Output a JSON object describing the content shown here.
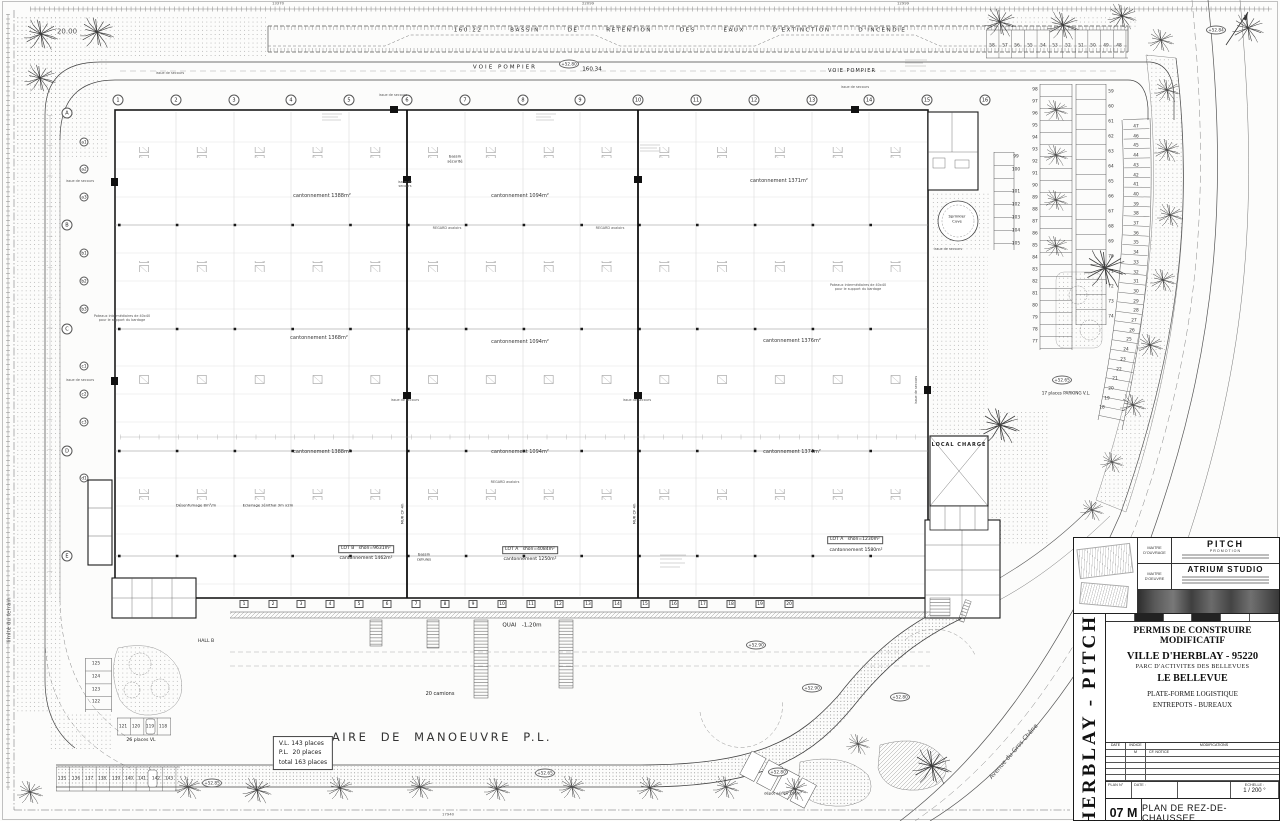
{
  "header": {
    "basin": "160.22   BASSIN   DE   RETENTION   DES   EAUX   D'EXTINCTION   D'INCENDIE",
    "voie_pompier_left": "VOIE POMPIER",
    "level": "160.34",
    "voie_pompier_right": "VOIE POMPIER"
  },
  "dims": [
    {
      "text": "13370",
      "x": 278,
      "y": 4
    },
    {
      "text": "22099",
      "x": 588,
      "y": 4
    },
    {
      "text": "12999",
      "x": 903,
      "y": 4
    },
    {
      "text": "17940",
      "x": 448,
      "y": 815
    }
  ],
  "grid": {
    "cols": [
      {
        "text": "1",
        "x": 118,
        "y": 100
      },
      {
        "text": "2",
        "x": 176,
        "y": 100
      },
      {
        "text": "3",
        "x": 234,
        "y": 100
      },
      {
        "text": "4",
        "x": 291,
        "y": 100
      },
      {
        "text": "5",
        "x": 349,
        "y": 100
      },
      {
        "text": "6",
        "x": 407,
        "y": 100
      },
      {
        "text": "7",
        "x": 465,
        "y": 100
      },
      {
        "text": "8",
        "x": 523,
        "y": 100
      },
      {
        "text": "9",
        "x": 580,
        "y": 100
      },
      {
        "text": "10",
        "x": 638,
        "y": 100
      },
      {
        "text": "11",
        "x": 696,
        "y": 100
      },
      {
        "text": "12",
        "x": 754,
        "y": 100
      },
      {
        "text": "13",
        "x": 812,
        "y": 100
      },
      {
        "text": "14",
        "x": 869,
        "y": 100
      },
      {
        "text": "15",
        "x": 927,
        "y": 100
      },
      {
        "text": "16",
        "x": 985,
        "y": 100
      }
    ],
    "rows": [
      {
        "text": "A",
        "x": 67,
        "y": 113
      },
      {
        "text": "B",
        "x": 67,
        "y": 225
      },
      {
        "text": "C",
        "x": 67,
        "y": 329
      },
      {
        "text": "D",
        "x": 67,
        "y": 451
      },
      {
        "text": "E",
        "x": 67,
        "y": 556
      }
    ],
    "subrows": [
      {
        "text": "a1",
        "x": 84,
        "y": 142
      },
      {
        "text": "a2",
        "x": 84,
        "y": 169
      },
      {
        "text": "a3",
        "x": 84,
        "y": 197
      },
      {
        "text": "b1",
        "x": 84,
        "y": 253
      },
      {
        "text": "b2",
        "x": 84,
        "y": 281
      },
      {
        "text": "b3",
        "x": 84,
        "y": 309
      },
      {
        "text": "c1",
        "x": 84,
        "y": 366
      },
      {
        "text": "c2",
        "x": 84,
        "y": 394
      },
      {
        "text": "c3",
        "x": 84,
        "y": 422
      },
      {
        "text": "d1",
        "x": 84,
        "y": 478
      }
    ]
  },
  "zones": [
    {
      "text": "cantonnement 1388m²",
      "x": 322,
      "y": 196
    },
    {
      "text": "cantonnement 1094m²",
      "x": 520,
      "y": 196
    },
    {
      "text": "cantonnement 1371m²",
      "x": 779,
      "y": 181
    },
    {
      "text": "cantonnement 1368m²",
      "x": 319,
      "y": 338
    },
    {
      "text": "cantonnement 1094m²",
      "x": 520,
      "y": 342
    },
    {
      "text": "cantonnement 1376m²",
      "x": 792,
      "y": 341
    },
    {
      "text": "cantonnement 1388m²",
      "x": 322,
      "y": 452
    },
    {
      "text": "cantonnement 1094m²",
      "x": 520,
      "y": 452
    },
    {
      "text": "cantonnement 1374m²",
      "x": 792,
      "y": 452
    }
  ],
  "annotations": [
    {
      "text": "160.22   BASSIN   DE   RETENTION   DES   EAUX   D'EXTINCTION   D'INCENDIE",
      "x": 680,
      "y": 31,
      "cls": "basin"
    },
    {
      "text": "VOIE POMPIER",
      "x": 505,
      "y": 68,
      "cls": "t55 sp2"
    },
    {
      "text": "160.34",
      "x": 592,
      "y": 70,
      "cls": "t55"
    },
    {
      "text": "VOIE POMPIER",
      "x": 852,
      "y": 71,
      "cls": "t5 sp1"
    },
    {
      "text": "issue de secours",
      "x": 170,
      "y": 73,
      "cls": "t3 gray"
    },
    {
      "text": "issue de secours",
      "x": 393,
      "y": 95,
      "cls": "t3 gray"
    },
    {
      "text": "issue de secours",
      "x": 855,
      "y": 87,
      "cls": "t3 gray"
    },
    {
      "text": "issue de\nsecours",
      "x": 405,
      "y": 184,
      "cls": "t3 gray"
    },
    {
      "text": "issue de secours",
      "x": 405,
      "y": 400,
      "cls": "t3 gray"
    },
    {
      "text": "issue de secours",
      "x": 637,
      "y": 400,
      "cls": "t3 gray"
    },
    {
      "text": "issue de secours",
      "x": 948,
      "y": 249,
      "cls": "t3 gray"
    },
    {
      "text": "issue de secours",
      "x": 80,
      "y": 181,
      "cls": "t3 gray"
    },
    {
      "text": "issue de secours",
      "x": 80,
      "y": 380,
      "cls": "t3 gray"
    },
    {
      "text": "issue de secours",
      "x": 916,
      "y": 390,
      "rot": -90,
      "cls": "t3 gray"
    },
    {
      "text": "REGARD avaloirs",
      "x": 447,
      "y": 228,
      "cls": "t3 gray"
    },
    {
      "text": "REGARD avaloirs",
      "x": 610,
      "y": 228,
      "cls": "t3 gray"
    },
    {
      "text": "REGARD avaloirs",
      "x": 505,
      "y": 482,
      "cls": "t3 gray"
    },
    {
      "text": "Poteaux intermédiaires de 40x40\npour le support du bardage",
      "x": 122,
      "y": 318,
      "cls": "t3 gray"
    },
    {
      "text": "Poteaux intermédiaires de 40x40\npour le support du bardage",
      "x": 858,
      "y": 287,
      "cls": "t3 gray"
    },
    {
      "text": "Désenfumage 8m²/m",
      "x": 196,
      "y": 506,
      "cls": "t35"
    },
    {
      "text": "Eclairage zénithal 3m x2m",
      "x": 268,
      "y": 506,
      "cls": "t35"
    },
    {
      "text": "bassin\nsécurité",
      "x": 455,
      "y": 159,
      "cls": "t35"
    },
    {
      "text": "bassin\ncellules",
      "x": 424,
      "y": 557,
      "cls": "t35"
    },
    {
      "text": "MUR CF 4h",
      "x": 403,
      "y": 514,
      "rot": -90,
      "cls": "t35"
    },
    {
      "text": "MUR CF 4h",
      "x": 635,
      "y": 514,
      "rot": -90,
      "cls": "t35"
    },
    {
      "text": "LOT B   shon=9631m²",
      "x": 366,
      "y": 549,
      "cls": "lot"
    },
    {
      "text": "cantonnement 1462m²",
      "x": 366,
      "y": 559,
      "cls": "t45"
    },
    {
      "text": "LOT A   shon=4084m²",
      "x": 530,
      "y": 550,
      "cls": "lot"
    },
    {
      "text": "cantonnement 1250m²",
      "x": 530,
      "y": 560,
      "cls": "t45"
    },
    {
      "text": "LOT A   shon=1230m²",
      "x": 855,
      "y": 540,
      "cls": "lot"
    },
    {
      "text": "cantonnement 1580m²",
      "x": 856,
      "y": 551,
      "cls": "t45"
    },
    {
      "text": "HALL B",
      "x": 206,
      "y": 642,
      "cls": "t45"
    },
    {
      "text": "QUAI   -1,20m",
      "x": 522,
      "y": 626,
      "cls": "t55"
    },
    {
      "text": "20 camions",
      "x": 440,
      "y": 694,
      "cls": "t5"
    },
    {
      "text": "AIRE  DE  MANOEUVRE  P.L.",
      "x": 442,
      "y": 737,
      "cls": "t11"
    },
    {
      "text": "V.L. 143 places\nP.L.  20 places\ntotal 163 places",
      "x": 303,
      "y": 753,
      "cls": "vlbox"
    },
    {
      "text": "17 places PARKING V.L.",
      "x": 1066,
      "y": 393,
      "cls": "t4"
    },
    {
      "text": "26 places VL",
      "x": 141,
      "y": 741,
      "cls": "t45"
    },
    {
      "text": "limite du terrain",
      "x": 10,
      "y": 620,
      "rot": -90,
      "cls": "t55 gray"
    },
    {
      "text": "20.00",
      "x": 67,
      "y": 32,
      "cls": "t7 gray"
    },
    {
      "text": "Avenue du Gros Chêne",
      "x": 1014,
      "y": 752,
      "rot": -49,
      "cls": "t6 gray"
    },
    {
      "text": "dépôt aérien 130m²",
      "x": 783,
      "y": 794,
      "cls": "t35"
    },
    {
      "text": "Sprinkler\nCuve",
      "x": 957,
      "y": 219,
      "cls": "t35"
    },
    {
      "text": "LOCAL CHARGE",
      "x": 959,
      "y": 445,
      "cls": "t5 bold sp1"
    }
  ],
  "spots": [
    {
      "text": "+52.80",
      "x": 569,
      "y": 64
    },
    {
      "text": "+52.84",
      "x": 1216,
      "y": 30
    },
    {
      "text": "+52.65",
      "x": 1062,
      "y": 380
    },
    {
      "text": "+52.85",
      "x": 212,
      "y": 783
    },
    {
      "text": "+52.65",
      "x": 545,
      "y": 773
    },
    {
      "text": "+52.90",
      "x": 756,
      "y": 645
    },
    {
      "text": "+52.90",
      "x": 812,
      "y": 688
    },
    {
      "text": "+52.80",
      "x": 900,
      "y": 697
    },
    {
      "text": "+52.80",
      "x": 778,
      "y": 772
    }
  ],
  "docks": [
    {
      "text": "1",
      "x": 244,
      "y": 604
    },
    {
      "text": "2",
      "x": 273,
      "y": 604
    },
    {
      "text": "3",
      "x": 301,
      "y": 604
    },
    {
      "text": "4",
      "x": 330,
      "y": 604
    },
    {
      "text": "5",
      "x": 359,
      "y": 604
    },
    {
      "text": "6",
      "x": 387,
      "y": 604
    },
    {
      "text": "7",
      "x": 416,
      "y": 604
    },
    {
      "text": "8",
      "x": 445,
      "y": 604
    },
    {
      "text": "9",
      "x": 473,
      "y": 604
    },
    {
      "text": "10",
      "x": 502,
      "y": 604
    },
    {
      "text": "11",
      "x": 531,
      "y": 604
    },
    {
      "text": "12",
      "x": 559,
      "y": 604
    },
    {
      "text": "13",
      "x": 588,
      "y": 604
    },
    {
      "text": "14",
      "x": 617,
      "y": 604
    },
    {
      "text": "15",
      "x": 645,
      "y": 604
    },
    {
      "text": "16",
      "x": 674,
      "y": 604
    },
    {
      "text": "17",
      "x": 703,
      "y": 604
    },
    {
      "text": "18",
      "x": 731,
      "y": 604
    },
    {
      "text": "19",
      "x": 760,
      "y": 604
    },
    {
      "text": "20",
      "x": 789,
      "y": 604
    }
  ],
  "parking": {
    "row_top": [
      {
        "text": "58",
        "x": 992,
        "y": 46
      },
      {
        "text": "57",
        "x": 1005,
        "y": 46
      },
      {
        "text": "56",
        "x": 1017,
        "y": 46
      },
      {
        "text": "55",
        "x": 1030,
        "y": 46
      },
      {
        "text": "54",
        "x": 1043,
        "y": 46
      },
      {
        "text": "53",
        "x": 1055,
        "y": 46
      },
      {
        "text": "52",
        "x": 1068,
        "y": 46
      },
      {
        "text": "51",
        "x": 1081,
        "y": 46
      },
      {
        "text": "50",
        "x": 1093,
        "y": 46
      },
      {
        "text": "49",
        "x": 1106,
        "y": 46
      },
      {
        "text": "48",
        "x": 1119,
        "y": 46
      }
    ],
    "col_a": [
      {
        "text": "98",
        "x": 1035,
        "y": 90
      },
      {
        "text": "97",
        "x": 1035,
        "y": 102
      },
      {
        "text": "96",
        "x": 1035,
        "y": 114
      },
      {
        "text": "95",
        "x": 1035,
        "y": 126
      },
      {
        "text": "94",
        "x": 1035,
        "y": 138
      },
      {
        "text": "93",
        "x": 1035,
        "y": 150
      },
      {
        "text": "92",
        "x": 1035,
        "y": 162
      },
      {
        "text": "91",
        "x": 1035,
        "y": 174
      },
      {
        "text": "90",
        "x": 1035,
        "y": 186
      },
      {
        "text": "89",
        "x": 1035,
        "y": 198
      },
      {
        "text": "88",
        "x": 1035,
        "y": 210
      },
      {
        "text": "87",
        "x": 1035,
        "y": 222
      },
      {
        "text": "86",
        "x": 1035,
        "y": 234
      },
      {
        "text": "85",
        "x": 1035,
        "y": 246
      },
      {
        "text": "84",
        "x": 1035,
        "y": 258
      },
      {
        "text": "83",
        "x": 1035,
        "y": 270
      },
      {
        "text": "82",
        "x": 1035,
        "y": 282
      },
      {
        "text": "81",
        "x": 1035,
        "y": 294
      },
      {
        "text": "80",
        "x": 1035,
        "y": 306
      },
      {
        "text": "79",
        "x": 1035,
        "y": 318
      },
      {
        "text": "78",
        "x": 1035,
        "y": 330
      },
      {
        "text": "77",
        "x": 1035,
        "y": 342
      }
    ],
    "col_b": [
      {
        "text": "59",
        "x": 1111,
        "y": 92
      },
      {
        "text": "60",
        "x": 1111,
        "y": 107
      },
      {
        "text": "61",
        "x": 1111,
        "y": 122
      },
      {
        "text": "62",
        "x": 1111,
        "y": 137
      },
      {
        "text": "63",
        "x": 1111,
        "y": 152
      },
      {
        "text": "64",
        "x": 1111,
        "y": 167
      },
      {
        "text": "65",
        "x": 1111,
        "y": 182
      },
      {
        "text": "66",
        "x": 1111,
        "y": 197
      },
      {
        "text": "67",
        "x": 1111,
        "y": 212
      },
      {
        "text": "68",
        "x": 1111,
        "y": 227
      },
      {
        "text": "69",
        "x": 1111,
        "y": 242
      },
      {
        "text": "70",
        "x": 1111,
        "y": 257
      },
      {
        "text": "71",
        "x": 1111,
        "y": 272
      },
      {
        "text": "72",
        "x": 1111,
        "y": 287
      },
      {
        "text": "73",
        "x": 1111,
        "y": 302
      },
      {
        "text": "74",
        "x": 1111,
        "y": 317
      }
    ],
    "col_c": [
      {
        "text": "47",
        "x": 1136,
        "y": 127
      },
      {
        "text": "46",
        "x": 1136,
        "y": 137
      },
      {
        "text": "45",
        "x": 1136,
        "y": 146
      },
      {
        "text": "44",
        "x": 1136,
        "y": 156
      },
      {
        "text": "43",
        "x": 1136,
        "y": 166
      },
      {
        "text": "42",
        "x": 1136,
        "y": 176
      },
      {
        "text": "41",
        "x": 1136,
        "y": 185
      },
      {
        "text": "40",
        "x": 1136,
        "y": 195
      },
      {
        "text": "39",
        "x": 1136,
        "y": 205
      },
      {
        "text": "38",
        "x": 1136,
        "y": 214
      },
      {
        "text": "37",
        "x": 1136,
        "y": 224
      },
      {
        "text": "36",
        "x": 1136,
        "y": 234
      },
      {
        "text": "35",
        "x": 1136,
        "y": 243
      },
      {
        "text": "34",
        "x": 1136,
        "y": 253
      },
      {
        "text": "33",
        "x": 1136,
        "y": 263
      },
      {
        "text": "32",
        "x": 1136,
        "y": 273
      },
      {
        "text": "31",
        "x": 1136,
        "y": 282
      },
      {
        "text": "30",
        "x": 1136,
        "y": 292
      },
      {
        "text": "29",
        "x": 1136,
        "y": 302
      },
      {
        "text": "28",
        "x": 1136,
        "y": 311
      },
      {
        "text": "27",
        "x": 1134,
        "y": 321
      },
      {
        "text": "26",
        "x": 1132,
        "y": 331
      },
      {
        "text": "25",
        "x": 1129,
        "y": 340
      },
      {
        "text": "24",
        "x": 1126,
        "y": 350
      },
      {
        "text": "23",
        "x": 1123,
        "y": 360
      },
      {
        "text": "22",
        "x": 1119,
        "y": 370
      },
      {
        "text": "21",
        "x": 1115,
        "y": 379
      },
      {
        "text": "20",
        "x": 1111,
        "y": 389
      },
      {
        "text": "19",
        "x": 1107,
        "y": 399
      },
      {
        "text": "18",
        "x": 1102,
        "y": 408
      }
    ],
    "col_mid": [
      {
        "text": "99",
        "x": 1016,
        "y": 157
      },
      {
        "text": "100",
        "x": 1016,
        "y": 170
      },
      {
        "text": "101",
        "x": 1016,
        "y": 192
      },
      {
        "text": "102",
        "x": 1016,
        "y": 205
      },
      {
        "text": "103",
        "x": 1016,
        "y": 218
      },
      {
        "text": "104",
        "x": 1016,
        "y": 231
      },
      {
        "text": "105",
        "x": 1016,
        "y": 244
      }
    ],
    "bl_col": [
      {
        "text": "125",
        "x": 96,
        "y": 664
      },
      {
        "text": "124",
        "x": 96,
        "y": 677
      },
      {
        "text": "123",
        "x": 96,
        "y": 690
      },
      {
        "text": "122",
        "x": 96,
        "y": 702
      }
    ],
    "bl_row": [
      {
        "text": "121",
        "x": 123,
        "y": 727
      },
      {
        "text": "120",
        "x": 136,
        "y": 727
      },
      {
        "text": "119",
        "x": 150,
        "y": 727
      },
      {
        "text": "118",
        "x": 163,
        "y": 727
      }
    ],
    "b_row": [
      {
        "text": "135",
        "x": 62,
        "y": 779
      },
      {
        "text": "136",
        "x": 76,
        "y": 779
      },
      {
        "text": "137",
        "x": 89,
        "y": 779
      },
      {
        "text": "138",
        "x": 102,
        "y": 779
      },
      {
        "text": "139",
        "x": 116,
        "y": 779
      },
      {
        "text": "140",
        "x": 129,
        "y": 779
      },
      {
        "text": "141",
        "x": 142,
        "y": 779
      },
      {
        "text": "142",
        "x": 156,
        "y": 779
      },
      {
        "text": "143",
        "x": 169,
        "y": 779
      }
    ]
  },
  "title_block": {
    "side": "HERBLAY  -  PITCH",
    "mo_label": "MAITRE\nD'OUVRAGE",
    "mo_name": "PITCH",
    "mo_sub": "PROMOTION",
    "moe_label": "MAITRE\nD'OEUVRE",
    "moe_name": "ATRIUM  STUDIO",
    "permit": "PERMIS DE CONSTRUIRE MODIFICATIF",
    "city": "VILLE D'HERBLAY - 95220",
    "parc": "PARC D'ACTIVITES  DES BELLEVUES",
    "bellevue": "LE BELLEVUE",
    "program1": "PLATE-FORME LOGISTIQUE",
    "program2": "ENTREPOTS - BUREAUX",
    "mod_date": "DATE",
    "mod_indice": "INDICE",
    "mod_title": "MODIFICATIONS",
    "mod_row_indice": "M",
    "mod_row_text": "CF. NOTICE",
    "plan_no_label": "PLAN N°",
    "date_label": "DATE :",
    "scale_label": "ECHELLE :",
    "scale_value": "1 / 200 °",
    "sheet_number": "07 M",
    "sheet_title": "PLAN DE REZ-DE-CHAUSSEE"
  }
}
